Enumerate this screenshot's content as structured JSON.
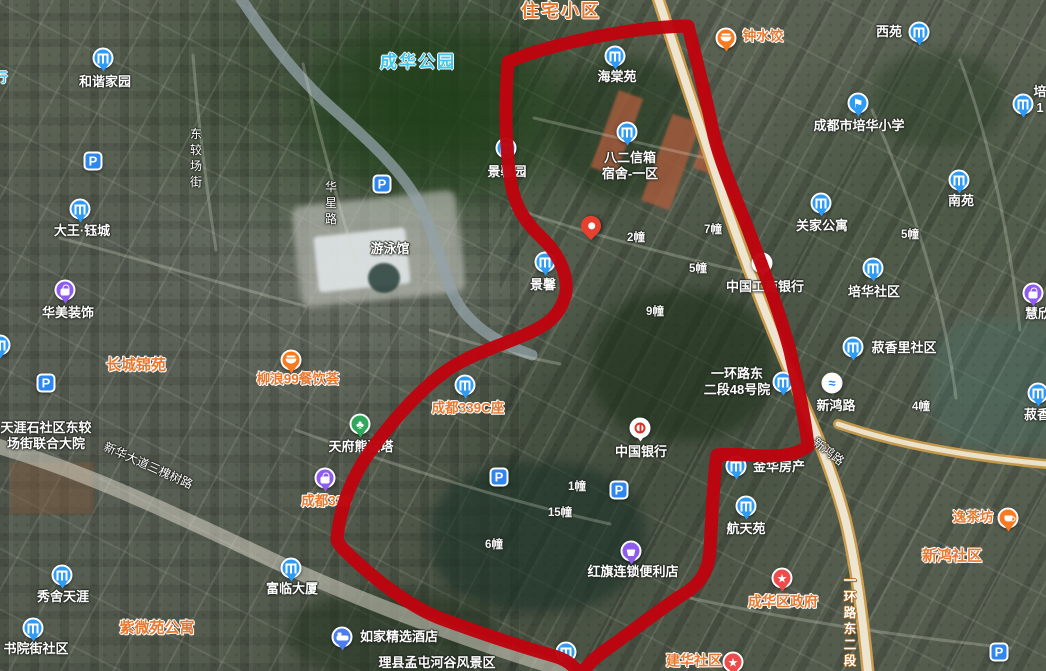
{
  "map": {
    "view": "satellite",
    "icon_colors": {
      "b": "#2E9BF7",
      "school": "#2E9BF7",
      "park": "#2E86F0",
      "food": "#F97A1F",
      "cup": "#F97A1F",
      "bag": "#8F5CF1",
      "cart": "#8F5CF1",
      "tree": "#2FA85C",
      "star": "#F04B4B",
      "bed": "#4A7DF0",
      "bridge": "#FFFFFF",
      "boc": "#FFFFFF",
      "icbc": "#FFFFFF"
    },
    "char_glyphs": {
      "school": "⚑",
      "star": "★",
      "tree": "♣",
      "park": "P",
      "bridge": "≈"
    },
    "marker": {
      "name": "dropped-location-pin",
      "x": 591,
      "y": 240
    },
    "features": [
      {
        "n": "area-zhuzhai-xiaoqu",
        "label": {
          "t": "住宅小区",
          "x": 561,
          "y": 11,
          "c": "orgBig"
        },
        "ia": false
      },
      {
        "n": "area-chenghua-park",
        "label": {
          "t": "成华公园",
          "x": 418,
          "y": 62,
          "c": "cyan"
        },
        "ia": false
      },
      {
        "n": "clipped-cyan-label",
        "label": {
          "t": "行",
          "x": 1,
          "y": 78,
          "c": "cyanSm"
        },
        "ia": false
      },
      {
        "n": "poi-hexie-jiayuan",
        "icon": {
          "k": "b",
          "x": 103,
          "y": 58
        },
        "label": {
          "t": "和谐家园",
          "x": 105,
          "y": 82,
          "c": "w"
        }
      },
      {
        "n": "poi-haitang-yuan",
        "icon": {
          "k": "b",
          "x": 615,
          "y": 56
        },
        "label": {
          "t": "海棠苑",
          "x": 617,
          "y": 77,
          "c": "w"
        }
      },
      {
        "n": "poi-zhongshuijiao",
        "icon": {
          "k": "food",
          "x": 726,
          "y": 38
        },
        "label": {
          "t": "钟水饺",
          "x": 763,
          "y": 37,
          "c": "org"
        }
      },
      {
        "n": "poi-xiyuan",
        "icon": {
          "k": "b",
          "x": 919,
          "y": 32
        },
        "label": {
          "t": "西苑",
          "x": 889,
          "y": 32,
          "c": "w"
        }
      },
      {
        "n": "poi-peihua-primary-school",
        "icon": {
          "k": "school",
          "x": 858,
          "y": 103
        },
        "label": {
          "t": "成都市培华小学",
          "x": 859,
          "y": 126,
          "c": "w"
        }
      },
      {
        "n": "poi-peihua-clipped",
        "icon": {
          "k": "b",
          "x": 1023,
          "y": 104
        },
        "label": {
          "lines": [
            "培",
            "1"
          ],
          "x": 1040,
          "y": 100,
          "c": "w"
        }
      },
      {
        "n": "poi-jingxin-yuan",
        "icon": {
          "k": "b",
          "x": 506,
          "y": 148
        },
        "label": {
          "t": "景馨园",
          "x": 507,
          "y": 172,
          "c": "w"
        }
      },
      {
        "n": "poi-baer-xinxiang",
        "icon": {
          "k": "b",
          "x": 627,
          "y": 132
        },
        "label": {
          "lines": [
            "八二信箱",
            "宿舍-一区"
          ],
          "x": 630,
          "y": 166,
          "c": "w"
        }
      },
      {
        "n": "poi-dawang-yucheng",
        "icon": {
          "k": "b",
          "x": 80,
          "y": 209
        },
        "label": {
          "t": "大王·钰城",
          "x": 82,
          "y": 231,
          "c": "w"
        }
      },
      {
        "n": "poi-guanjia-gongyu",
        "icon": {
          "k": "b",
          "x": 821,
          "y": 203
        },
        "label": {
          "t": "关家公寓",
          "x": 822,
          "y": 226,
          "c": "w"
        }
      },
      {
        "n": "poi-nanyuan",
        "icon": {
          "k": "b",
          "x": 959,
          "y": 180
        },
        "label": {
          "t": "南苑",
          "x": 961,
          "y": 201,
          "c": "w"
        }
      },
      {
        "n": "parking-1",
        "icon": {
          "k": "park",
          "x": 93,
          "y": 161
        }
      },
      {
        "n": "parking-2",
        "icon": {
          "k": "park",
          "x": 382,
          "y": 184
        }
      },
      {
        "n": "parking-3",
        "icon": {
          "k": "park",
          "x": 46,
          "y": 383
        }
      },
      {
        "n": "parking-4",
        "icon": {
          "k": "park",
          "x": 499,
          "y": 477
        }
      },
      {
        "n": "parking-5",
        "icon": {
          "k": "park",
          "x": 619,
          "y": 490
        }
      },
      {
        "n": "parking-6",
        "icon": {
          "k": "park",
          "x": 999,
          "y": 652
        }
      },
      {
        "n": "poi-jingxin-clipped",
        "icon": {
          "k": "b",
          "x": 545,
          "y": 262
        },
        "label": {
          "t": "景馨",
          "x": 543,
          "y": 285,
          "c": "w"
        }
      },
      {
        "n": "bldg-2",
        "label": {
          "t": "2幢",
          "x": 636,
          "y": 238,
          "c": "num"
        },
        "ia": false
      },
      {
        "n": "bldg-7",
        "label": {
          "t": "7幢",
          "x": 713,
          "y": 230,
          "c": "num"
        },
        "ia": false
      },
      {
        "n": "bldg-5-inner",
        "label": {
          "t": "5幢",
          "x": 698,
          "y": 269,
          "c": "num"
        },
        "ia": false
      },
      {
        "n": "bldg-9",
        "label": {
          "t": "9幢",
          "x": 655,
          "y": 312,
          "c": "num"
        },
        "ia": false
      },
      {
        "n": "bldg-5",
        "label": {
          "t": "5幢",
          "x": 910,
          "y": 235,
          "c": "num"
        },
        "ia": false
      },
      {
        "n": "bldg-4",
        "label": {
          "t": "4幢",
          "x": 921,
          "y": 407,
          "c": "num"
        },
        "ia": false
      },
      {
        "n": "bldg-1",
        "label": {
          "t": "1幢",
          "x": 577,
          "y": 487,
          "c": "num"
        },
        "ia": false
      },
      {
        "n": "bldg-15",
        "label": {
          "t": "15幢",
          "x": 560,
          "y": 513,
          "c": "num"
        },
        "ia": false
      },
      {
        "n": "bldg-6",
        "label": {
          "t": "6幢",
          "x": 494,
          "y": 545,
          "c": "num"
        },
        "ia": false
      },
      {
        "n": "poi-icbc-bank",
        "icon": {
          "k": "icbc",
          "x": 762,
          "y": 263
        },
        "label": {
          "t": "中国工商银行",
          "x": 765,
          "y": 287,
          "c": "w"
        }
      },
      {
        "n": "poi-peihua-shequ",
        "icon": {
          "k": "b",
          "x": 873,
          "y": 268
        },
        "label": {
          "t": "培华社区",
          "x": 874,
          "y": 292,
          "c": "w"
        }
      },
      {
        "n": "road-huaxing",
        "label": {
          "t": "华星路",
          "x": 331,
          "y": 203,
          "c": "road vert",
          "vert": true
        },
        "ia": false
      },
      {
        "n": "road-dongjiaochang",
        "label": {
          "t": "东较场街",
          "x": 196,
          "y": 158,
          "c": "road vert",
          "vert": true
        },
        "ia": false
      },
      {
        "n": "poi-youyongguan",
        "label": {
          "t": "游泳馆",
          "x": 390,
          "y": 249,
          "c": "w"
        }
      },
      {
        "n": "poi-huamei-zhuangshi",
        "icon": {
          "k": "bag",
          "x": 65,
          "y": 290
        },
        "label": {
          "t": "华美装饰",
          "x": 68,
          "y": 313,
          "c": "w"
        }
      },
      {
        "n": "area-changcheng-jinyuan",
        "label": {
          "t": "长城锦苑",
          "x": 136,
          "y": 366,
          "c": "orgArea"
        },
        "ia": false
      },
      {
        "n": "poi-tianyashi-dayuan",
        "label": {
          "lines": [
            "天涯石社区东较",
            "场街联合大院"
          ],
          "x": 46,
          "y": 436,
          "c": "w"
        }
      },
      {
        "n": "poi-liulang99",
        "icon": {
          "k": "food",
          "x": 291,
          "y": 360
        },
        "label": {
          "t": "柳浪99餐饮荟",
          "x": 298,
          "y": 380,
          "c": "org"
        }
      },
      {
        "n": "poi-chengdu339c",
        "icon": {
          "k": "b",
          "x": 465,
          "y": 385
        },
        "label": {
          "t": "成都339C座",
          "x": 468,
          "y": 409,
          "c": "org"
        }
      },
      {
        "n": "poi-panda-tower",
        "icon": {
          "k": "tree",
          "x": 360,
          "y": 424
        },
        "label": {
          "t": "天府熊猫塔",
          "x": 361,
          "y": 447,
          "c": "w"
        }
      },
      {
        "n": "poi-chengdu339",
        "icon": {
          "k": "bag",
          "x": 325,
          "y": 478
        },
        "label": {
          "t": "成都339",
          "x": 326,
          "y": 502,
          "c": "org"
        }
      },
      {
        "n": "poi-shuxiangli-shequ",
        "icon": {
          "k": "b",
          "x": 853,
          "y": 347
        },
        "label": {
          "t": "菽香里社区",
          "x": 904,
          "y": 348,
          "c": "w"
        }
      },
      {
        "n": "poi-huixin-clipped",
        "icon": {
          "k": "bag",
          "x": 1033,
          "y": 293
        },
        "label": {
          "t": "慧欣",
          "x": 1038,
          "y": 314,
          "c": "w"
        }
      },
      {
        "n": "poi-xinhong-overpass",
        "icon": {
          "k": "bridge",
          "x": 832,
          "y": 383
        },
        "label": {
          "t": "新鸿路",
          "x": 836,
          "y": 406,
          "c": "w"
        }
      },
      {
        "n": "road-xinhong-diagonal",
        "label": {
          "t": "新鸿路",
          "x": 828,
          "y": 452,
          "c": "road",
          "rotate": 38
        },
        "ia": false
      },
      {
        "n": "poi-yihuanlu-48",
        "icon": {
          "k": "b",
          "x": 783,
          "y": 382
        },
        "label": {
          "lines": [
            "一环路东",
            "二段48号院"
          ],
          "x": 737,
          "y": 382,
          "c": "w"
        }
      },
      {
        "n": "poi-jinhua-fangchan",
        "icon": {
          "k": "b",
          "x": 736,
          "y": 466
        },
        "label": {
          "t": "金华房产",
          "x": 779,
          "y": 467,
          "c": "w"
        }
      },
      {
        "n": "poi-bank-of-china",
        "icon": {
          "k": "boc",
          "x": 640,
          "y": 428
        },
        "label": {
          "t": "中国银行",
          "x": 641,
          "y": 452,
          "c": "w"
        }
      },
      {
        "n": "poi-hangtian-yuan",
        "icon": {
          "k": "b",
          "x": 746,
          "y": 506
        },
        "label": {
          "t": "航天苑",
          "x": 746,
          "y": 529,
          "c": "w"
        }
      },
      {
        "n": "poi-hongqi-store",
        "icon": {
          "k": "cart",
          "x": 631,
          "y": 551
        },
        "label": {
          "t": "红旗连锁便利店",
          "x": 633,
          "y": 572,
          "c": "w"
        }
      },
      {
        "n": "poi-shuxiang-clipped",
        "icon": {
          "k": "b",
          "x": 1038,
          "y": 393
        },
        "label": {
          "t": "菽香",
          "x": 1037,
          "y": 415,
          "c": "w"
        }
      },
      {
        "n": "road-yihuanlu-east2",
        "label": {
          "t": "一环路东二段",
          "x": 850,
          "y": 621,
          "c": "roadOrg vert",
          "vert": true
        },
        "ia": false
      },
      {
        "n": "road-xinhua-dadao",
        "label": {
          "t": "新华大道三槐树路",
          "x": 148,
          "y": 466,
          "c": "road",
          "rotate": 24
        },
        "ia": false
      },
      {
        "n": "poi-xiushe-tianya",
        "icon": {
          "k": "b",
          "x": 62,
          "y": 575
        },
        "label": {
          "t": "秀舍天涯",
          "x": 63,
          "y": 597,
          "c": "w"
        }
      },
      {
        "n": "poi-shuyuanjie-shequ",
        "icon": {
          "k": "b",
          "x": 33,
          "y": 628
        },
        "label": {
          "t": "书院街社区",
          "x": 36,
          "y": 649,
          "c": "w"
        }
      },
      {
        "n": "area-ziweiyuan-gongyu",
        "label": {
          "t": "紫微苑公寓",
          "x": 157,
          "y": 629,
          "c": "orgArea"
        },
        "ia": false
      },
      {
        "n": "poi-fulin-dasha",
        "icon": {
          "k": "b",
          "x": 291,
          "y": 568
        },
        "label": {
          "t": "富临大厦",
          "x": 292,
          "y": 589,
          "c": "w"
        }
      },
      {
        "n": "poi-rujia-hotel",
        "icon": {
          "k": "bed",
          "x": 342,
          "y": 637
        },
        "label": {
          "t": "如家精选酒店",
          "x": 399,
          "y": 637,
          "c": "w"
        }
      },
      {
        "n": "poi-lixian-scenic",
        "icon": {
          "k": "b",
          "x": 566,
          "y": 652
        },
        "label": {
          "t": "理县孟屯河谷风景区",
          "x": 437,
          "y": 663,
          "c": "w"
        }
      },
      {
        "n": "poi-chenghua-government",
        "icon": {
          "k": "star",
          "x": 782,
          "y": 578
        },
        "label": {
          "t": "成华区政府",
          "x": 783,
          "y": 602,
          "c": "gov"
        }
      },
      {
        "n": "poi-jianhua-shequ",
        "icon": {
          "k": "star",
          "x": 733,
          "y": 662
        },
        "label": {
          "t": "建华社区",
          "x": 694,
          "y": 661,
          "c": "gov"
        }
      },
      {
        "n": "area-xinhong-shequ",
        "label": {
          "t": "新鸿社区",
          "x": 952,
          "y": 557,
          "c": "orgArea"
        },
        "ia": false
      },
      {
        "n": "poi-yichafang",
        "icon": {
          "k": "cup",
          "x": 1008,
          "y": 518
        },
        "label": {
          "t": "逸茶坊",
          "x": 973,
          "y": 518,
          "c": "org"
        }
      },
      {
        "n": "poi-clipped-left",
        "icon": {
          "k": "b",
          "x": 0,
          "y": 345
        }
      }
    ],
    "annotations": {
      "boundary": {
        "color": "#BE040E",
        "width": 13,
        "path": "M508 62 C556 42 634 27 688 26 C697 62 706 97 714 136 C723 171 740 207 753 242 C766 276 781 317 790 351 C798 387 805 417 808 446 C800 453 786 456 769 456 C751 456 731 453 717 455 C713 481 712 517 710 549 C709 571 700 585 682 595 C659 610 630 633 607 649 C596 657 589 663 584 671 L577 671 C571 663 564 659 554 656 C515 645 472 630 442 619 C412 608 379 582 359 564 C345 551 338 545 337 539 C340 507 352 477 369 453 C389 425 417 392 446 371 C472 353 503 345 529 333 C549 324 562 313 566 292 C568 271 556 251 541 237 C524 221 514 205 510 177 C505 139 505 100 508 62 Z"
      },
      "roads": {
        "edge_color": "#D8A44C",
        "fill_color": "#EFE9D7",
        "main": "M656 -8 C680 66 704 140 726 205 C748 270 772 330 794 382 C814 428 832 470 844 515 C854 553 862 610 868 672",
        "branch": "M838 424 C890 442 960 456 1046 464",
        "avenue": "M-10 444 C90 472 190 522 285 566 C365 602 470 642 565 670",
        "avenue_color": "#E4E0D2",
        "canal": "M238 -6 C268 40 300 80 332 108 C366 138 402 170 420 205 C436 238 441 267 453 294 C467 325 498 343 532 355",
        "canal_color": "#93A2A8",
        "minor_color": "#D6DAC8",
        "minor": [
          "M303 64 C318 130 336 196 356 262",
          "M193 55 C198 120 206 185 216 250",
          "M512 208 C600 238 690 260 762 276",
          "M534 118 C610 136 668 150 706 158",
          "M296 430 C400 468 520 504 610 524",
          "M60 238 C150 262 230 286 305 306",
          "M872 110 C912 200 944 300 956 398",
          "M690 598 C800 622 900 636 1010 648",
          "M960 60 C990 140 1010 240 1020 330",
          "M430 330 C480 346 520 356 560 364"
        ]
      }
    }
  }
}
